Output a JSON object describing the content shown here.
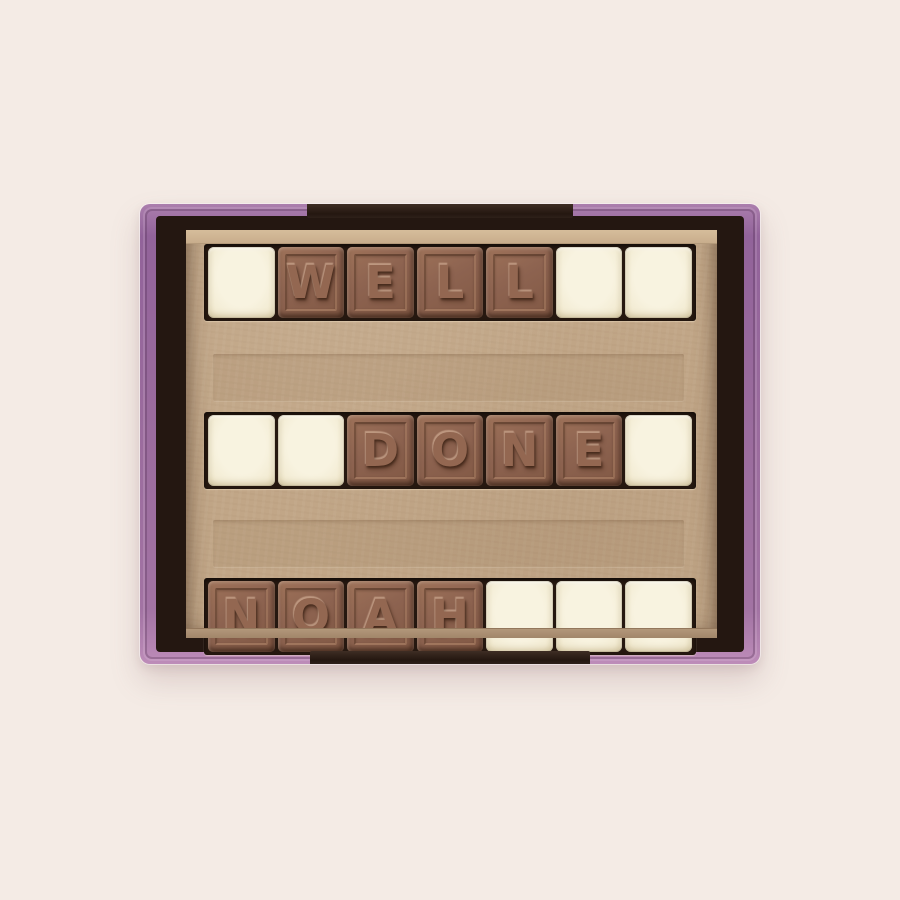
{
  "photo": {
    "subject": "Personalised chocolate message gift box on a cream background",
    "message": "WELL DONE NOAH"
  },
  "box": {
    "rows": [
      {
        "name": "row-1",
        "cells": [
          {
            "type": "white",
            "letter": ""
          },
          {
            "type": "milk",
            "letter": "W"
          },
          {
            "type": "milk",
            "letter": "E"
          },
          {
            "type": "milk",
            "letter": "L"
          },
          {
            "type": "milk",
            "letter": "L"
          },
          {
            "type": "white",
            "letter": ""
          },
          {
            "type": "white",
            "letter": ""
          }
        ]
      },
      {
        "name": "row-2",
        "cells": [
          {
            "type": "white",
            "letter": ""
          },
          {
            "type": "white",
            "letter": ""
          },
          {
            "type": "milk",
            "letter": "D"
          },
          {
            "type": "milk",
            "letter": "O"
          },
          {
            "type": "milk",
            "letter": "N"
          },
          {
            "type": "milk",
            "letter": "E"
          },
          {
            "type": "white",
            "letter": ""
          }
        ]
      },
      {
        "name": "row-3",
        "cells": [
          {
            "type": "milk",
            "letter": "N"
          },
          {
            "type": "milk",
            "letter": "O"
          },
          {
            "type": "milk",
            "letter": "A"
          },
          {
            "type": "milk",
            "letter": "H"
          },
          {
            "type": "white",
            "letter": ""
          },
          {
            "type": "white",
            "letter": ""
          },
          {
            "type": "white",
            "letter": ""
          }
        ]
      }
    ]
  },
  "colors": {
    "background": "#f4ebe5",
    "rim_purple": "#9a6b9d",
    "rim_dark_accent": "#2a1c14",
    "kraft_tray": "#c1a687",
    "slot_dark": "#261810",
    "milk_chocolate": "#8d6350",
    "white_chocolate": "#f5efdc"
  }
}
